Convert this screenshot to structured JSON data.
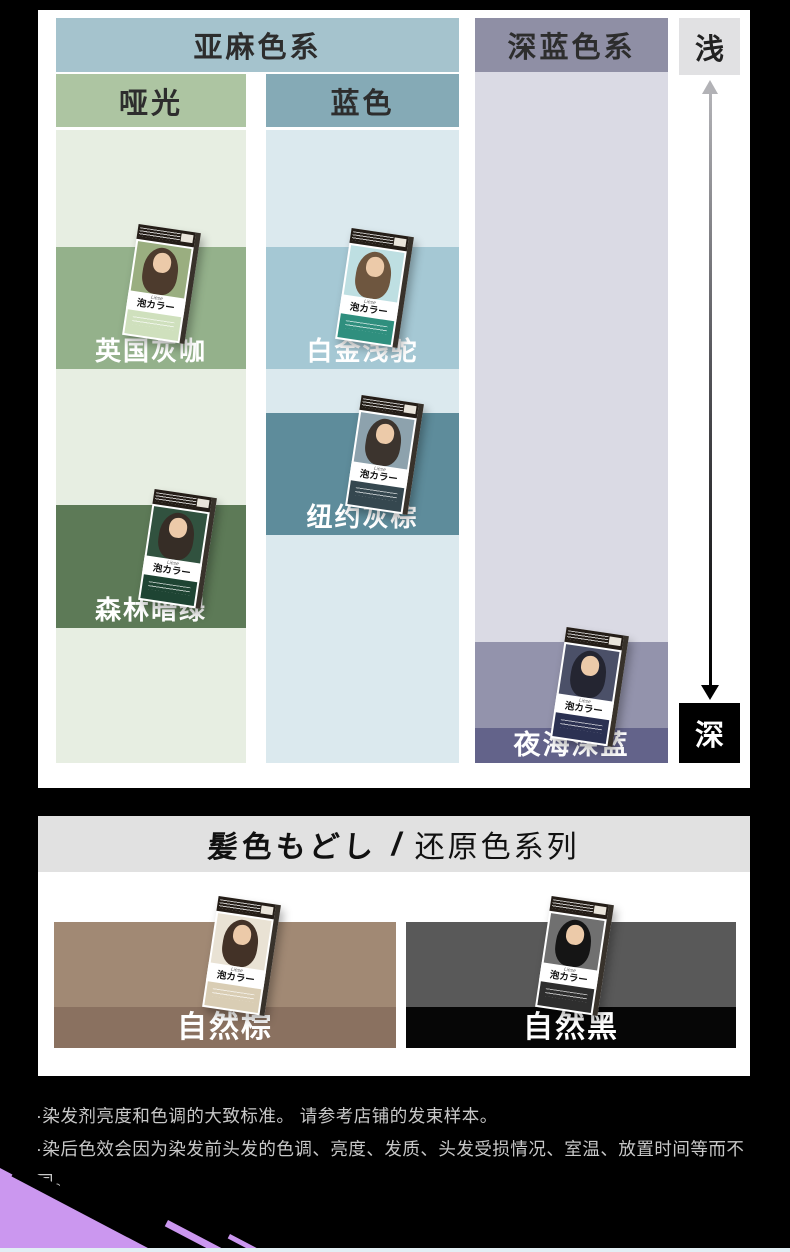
{
  "page": {
    "background": "#000000"
  },
  "section1": {
    "group_headers": [
      {
        "label": "亚麻色系",
        "bg": "#a5c3cd"
      },
      {
        "label": "深蓝色系",
        "bg": "#8f8fa5"
      }
    ],
    "scale": {
      "light_label": "浅",
      "dark_label": "深",
      "light_box_bg": "#e1e1e3",
      "dark_box_bg": "#000000"
    },
    "finish_headers": [
      {
        "label": "哑光",
        "bg": "#adc5a2"
      },
      {
        "label": "蓝色",
        "bg": "#85aab6"
      }
    ],
    "columns": [
      {
        "bg": "#e7eee2"
      },
      {
        "bg": "#dbe9ee"
      },
      {
        "bg": "#dadae4"
      }
    ],
    "products": [
      {
        "label": "英国灰咖",
        "band_bg": "#94b18b",
        "box": {
          "photo": "#9aae80",
          "hair": "#4d3b2d",
          "bottom": "#cfe0bd"
        }
      },
      {
        "label": "白金浅驼",
        "band_bg": "#a5c8d4",
        "box": {
          "photo": "#bedfe2",
          "hair": "#6e563f",
          "bottom": "#2f8f7e"
        }
      },
      {
        "label": "纽约灰棕",
        "band_bg": "#5e8c9b",
        "box": {
          "photo": "#8da2ad",
          "hair": "#3c342e",
          "bottom": "#35474f"
        }
      },
      {
        "label": "森林暗绿",
        "band_bg": "#5d7a57",
        "box": {
          "photo": "#31523f",
          "hair": "#362d26",
          "bottom": "#1e4433"
        }
      },
      {
        "label": "夜海深蓝",
        "band_bg": "#9393ac",
        "label_band_bg": "#63638a",
        "box": {
          "photo": "#4b5068",
          "hair": "#242531",
          "bottom": "#2b3152"
        }
      }
    ],
    "product_box": {
      "brand": "Liese",
      "logo": "泡カラー"
    }
  },
  "section2": {
    "title": {
      "jp": "髪色もどし",
      "separator": "/",
      "cn": "还原色系列",
      "bg": "#e1e1e1"
    },
    "products": [
      {
        "label": "自然棕",
        "band_bg": "#a18974",
        "label_band_bg": "#8a7160",
        "box": {
          "photo": "#e9e2d4",
          "hair": "#433227",
          "bottom": "#d9cdb4"
        }
      },
      {
        "label": "自然黑",
        "band_bg": "#595959",
        "label_band_bg": "#060606",
        "box": {
          "photo": "#707070",
          "hair": "#151515",
          "bottom": "#2e2e2e"
        }
      }
    ]
  },
  "footnotes": [
    "·染发剂亮度和色调的大致标准。 请参考店铺的发束样本。",
    "·染后色效会因为染发前头发的色调、亮度、发质、头发受损情况、室温、放置时间等而不同。"
  ],
  "decor": {
    "corner_color": "#cb97ef",
    "bottom_strip_color": "#e2eff5"
  }
}
